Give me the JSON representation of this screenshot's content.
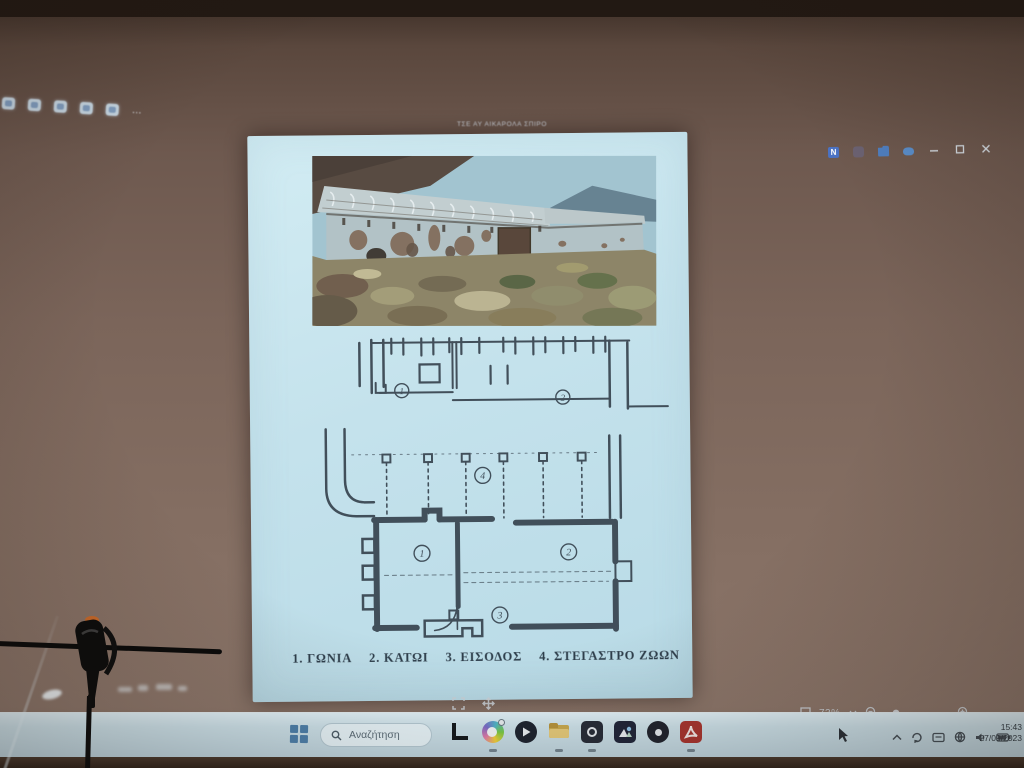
{
  "app_window": {
    "title": "ΤΣΕ ΑΥ ΑΙΚΑΡΟΛΑ ΣΠΙΡΟ",
    "toolbar_more": "…"
  },
  "viewer": {
    "zoom_level": "73%"
  },
  "doc": {
    "caption": [
      "1. ΓΩΝΙΑ",
      "2. ΚΑΤΩΙ",
      "3. ΕΙΣΟΔΟΣ",
      "4. ΣΤΕΓΑΣΤΡΟ ΖΩΩΝ"
    ],
    "plan_labels": {
      "n1": "1",
      "n2": "2",
      "n3": "3",
      "n4": "4"
    },
    "elevation_labels": {
      "n1": "1",
      "n2": "2"
    }
  },
  "taskbar": {
    "search": "Αναζήτηση",
    "clock_time": "15:43",
    "clock_date": "27/09/2023"
  },
  "colors": {
    "page": "#c4e2ec",
    "wall": "#7b655a",
    "ink": "#37434e",
    "taskbar": "#cde2ea",
    "accent_blue": "#4d80ab",
    "acrobat_red": "#a8352f"
  }
}
